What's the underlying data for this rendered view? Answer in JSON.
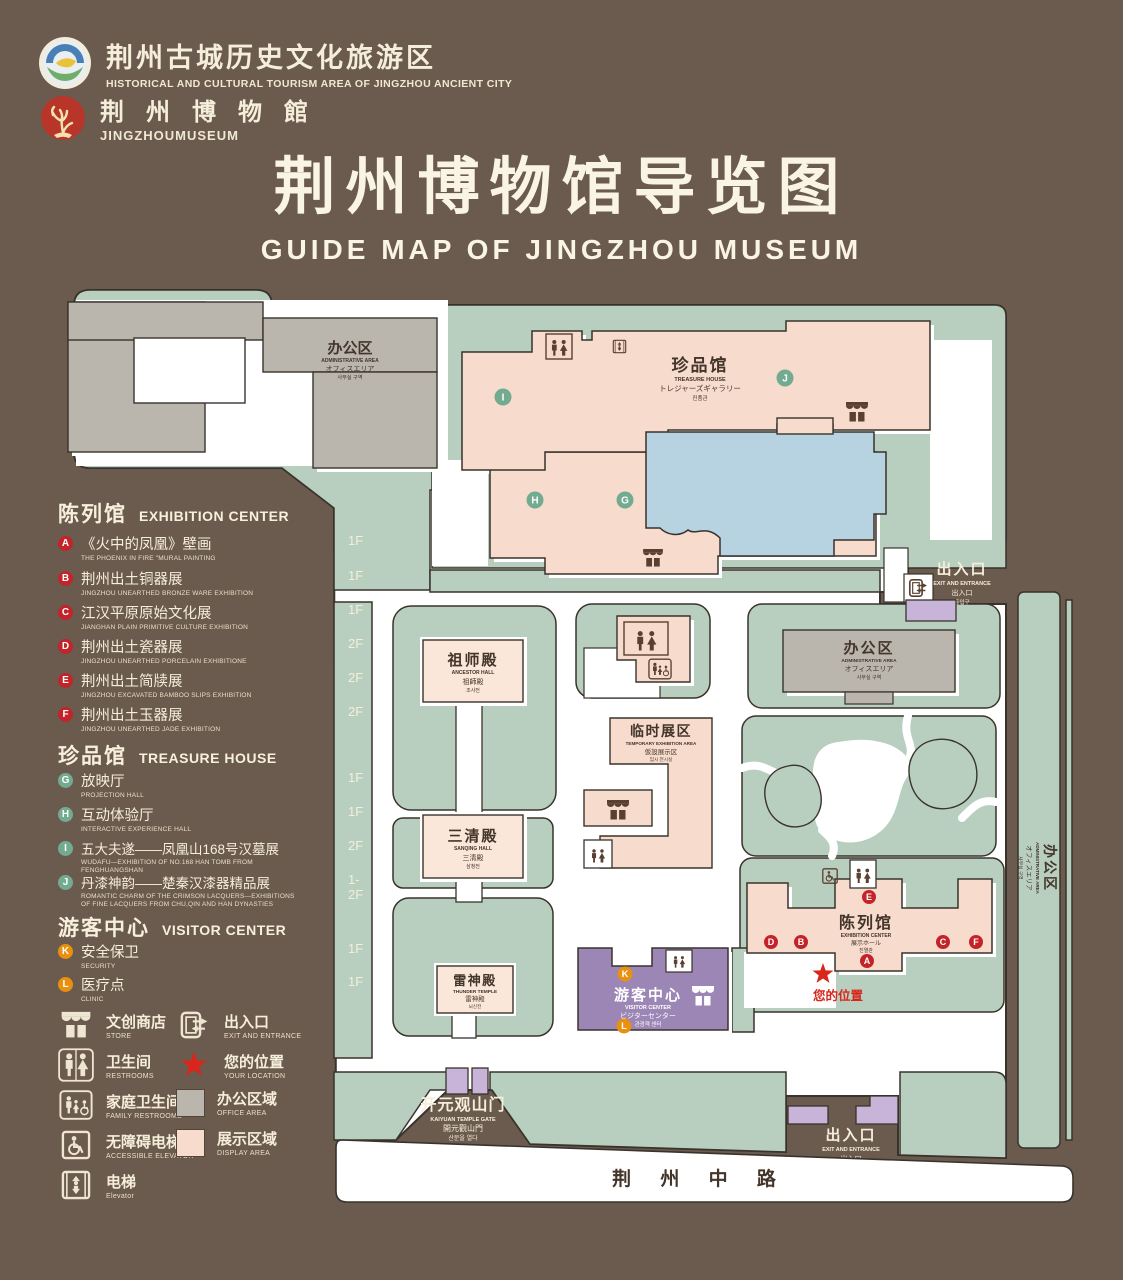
{
  "header": {
    "org": {
      "zh": "荆州古城历史文化旅游区",
      "en": "HISTORICAL AND CULTURAL TOURISM AREA OF JINGZHOU ANCIENT CITY"
    },
    "museum": {
      "zh": "荆 州 博 物 館",
      "en": "JINGZHOUMUSEUM"
    },
    "title": {
      "zh": "荆州博物馆导览图",
      "en": "GUIDE MAP OF JINGZHOU MUSEUM"
    }
  },
  "legend": {
    "sections": [
      {
        "zh": "陈列馆",
        "en": "EXHIBITION CENTER",
        "items": [
          {
            "id": "A",
            "zh": "《火中的凤凰》壁画",
            "en": "THE PHOENIX IN FIRE \"MURAL PAINTING",
            "floor": "1F"
          },
          {
            "id": "B",
            "zh": "荆州出土铜器展",
            "en": "JINGZHOU UNEARTHED BRONZE WARE EXHIBITION",
            "floor": "1F"
          },
          {
            "id": "C",
            "zh": "江汉平原原始文化展",
            "en": "JIANGHAN PLAIN PRIMITIVE CULTURE EXHIBITION",
            "floor": "1F"
          },
          {
            "id": "D",
            "zh": "荆州出土瓷器展",
            "en": "JINGZHOU UNEARTHED PORCELAIN EXHIBITIONE",
            "floor": "2F"
          },
          {
            "id": "E",
            "zh": "荆州出土简牍展",
            "en": "JINGZHOU EXCAVATED BAMBOO SLIPS EXHIBITION",
            "floor": "2F"
          },
          {
            "id": "F",
            "zh": "荆州出土玉器展",
            "en": "JINGZHOU UNEARTHED JADE EXHIBITION",
            "floor": "2F"
          }
        ]
      },
      {
        "zh": "珍品馆",
        "en": "TREASURE HOUSE",
        "items": [
          {
            "id": "G",
            "zh": "放映厅",
            "en": "PROJECTION HALL",
            "floor": "1F"
          },
          {
            "id": "H",
            "zh": "互动体验厅",
            "en": "INTERACTIVE EXPERIENCE HALL",
            "floor": "1F"
          },
          {
            "id": "I",
            "zh": "五大夫遂——凤凰山168号汉墓展",
            "en": "WUDAFU—EXHIBITION OF NO.168 HAN TOMB FROM FENGHUANGSHAN",
            "floor": "2F"
          },
          {
            "id": "J",
            "zh": "丹漆神韵——楚秦汉漆器精品展",
            "en": "ROMANTIC CHARM OF THE CRIMSON LACQUERS—EXHIBITIONS OF FINE LACQUERS FROM CHU,QIN AND HAN DYNASTIES",
            "floor": "1-2F"
          }
        ]
      },
      {
        "zh": "游客中心",
        "en": "VISITOR CENTER",
        "items": [
          {
            "id": "K",
            "zh": "安全保卫",
            "en": "SECURITY",
            "floor": "1F"
          },
          {
            "id": "L",
            "zh": "医疗点",
            "en": "CLINIC",
            "floor": "1F"
          }
        ]
      }
    ],
    "facilities": [
      {
        "zh": "文创商店",
        "en": "STORE"
      },
      {
        "zh": "出入口",
        "en": "EXIT AND ENTRANCE"
      },
      {
        "zh": "卫生间",
        "en": "RESTROOMS"
      },
      {
        "zh": "您的位置",
        "en": "YOUR LOCATION"
      },
      {
        "zh": "家庭卫生间",
        "en": "FAMILY RESTROOMS"
      },
      {
        "zh": "办公区域",
        "en": "OFFICE AREA"
      },
      {
        "zh": "无障碍电梯",
        "en": "ACCESSIBLE ELEVATOR"
      },
      {
        "zh": "展示区域",
        "en": "DISPLAY AREA"
      },
      {
        "zh": "电梯",
        "en": "Elevator"
      }
    ]
  },
  "map": {
    "buildings": {
      "admin_tl": {
        "zh": "办公区",
        "en": "ADMINISTRATIVE AREA",
        "ja": "オフィスエリア",
        "ko": "사무실 구역"
      },
      "treasure": {
        "zh": "珍品馆",
        "en": "TREASURE HOUSE",
        "ja": "トレジャーズギャラリー",
        "ko": "진품관"
      },
      "ancestor": {
        "zh": "祖师殿",
        "en": "ANCESTOR HALL",
        "ja": "祖師殿",
        "ko": "조사전"
      },
      "sanqing": {
        "zh": "三清殿",
        "en": "SANQING HALL",
        "ja": "三清殿",
        "ko": "삼청전"
      },
      "thunder": {
        "zh": "雷神殿",
        "en": "THUNDER TEMPLE",
        "ja": "雷神殿",
        "ko": "뇌신전"
      },
      "temporary": {
        "zh": "临时展区",
        "en": "TEMPORARY EXHIBITION AREA",
        "ja": "仮設展示区",
        "ko": "임시 전시실"
      },
      "admin_r": {
        "zh": "办公区",
        "en": "ADMINISTRATIVE AREA",
        "ja": "オフィスエリア",
        "ko": "사무실 구역"
      },
      "admin_strip": {
        "zh": "办公区",
        "en": "ADMINISTRATIVE AREA",
        "ja": "オフィスエリア",
        "ko": "사무실 구역"
      },
      "visitor": {
        "zh": "游客中心",
        "en": "VISITOR CENTER",
        "ja": "ビジターセンター",
        "ko": "관광객 센터"
      },
      "exhibition": {
        "zh": "陈列馆",
        "en": "EXHIBITION CENTER",
        "ja": "展示ホール",
        "ko": "진열관"
      },
      "exit_top": {
        "zh": "出入口",
        "en": "EXIT AND ENTRANCE",
        "ja": "出入口",
        "ko": "출입구"
      },
      "exit_bottom": {
        "zh": "出入口",
        "en": "EXIT AND ENTRANCE",
        "ja": "出入口",
        "ko": "출입구"
      },
      "gate": {
        "zh": "开元观山门",
        "en": "KAIYUAN TEMPLE GATE",
        "ja": "開元觀山門",
        "ko": "산문을 열다"
      },
      "road": {
        "zh": "荆 州 中 路"
      },
      "your_location": {
        "zh": "您的位置"
      }
    },
    "markers": [
      {
        "letter": "I"
      },
      {
        "letter": "J"
      },
      {
        "letter": "H"
      },
      {
        "letter": "G"
      },
      {
        "letter": "E"
      },
      {
        "letter": "D"
      },
      {
        "letter": "B"
      },
      {
        "letter": "C"
      },
      {
        "letter": "F"
      },
      {
        "letter": "A"
      },
      {
        "letter": "K"
      },
      {
        "letter": "L"
      }
    ],
    "colors": {
      "background": "#6b5b4e",
      "campus_green": "#b8cfc0",
      "display_pink": "#f7dccd",
      "office_gray": "#bab5ad",
      "lake_blue": "#b7d2e0",
      "visitor_purple": "#9c86b6",
      "gate_purple": "#c9b4d9",
      "badge_red": "#c2242a",
      "badge_green": "#72ab90",
      "badge_orange": "#e9900e",
      "location_red": "#d8261c",
      "road_white": "#ffffff"
    }
  }
}
